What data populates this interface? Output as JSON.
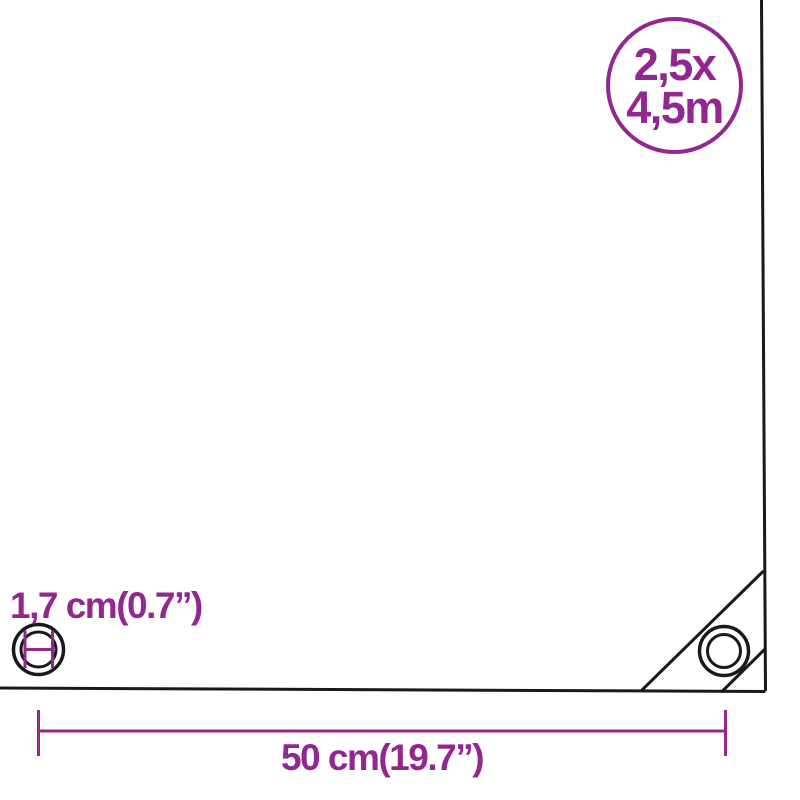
{
  "diagram": {
    "size_badge": {
      "line1": "2,5x",
      "line2": "4,5m"
    },
    "eyelet_diameter_label": "1,7 cm(0.7”)",
    "grommet_spacing_label": "50 cm(19.7”)"
  },
  "colors": {
    "accent_purple": "#92278F",
    "outline_black": "#191919",
    "background": "#FFFFFF"
  },
  "icons": {
    "eyelet_diameter_icon": "double-black-circle-with-purple-inner-diameter-measure",
    "corner_grommet_icon": "double-black-circle-grommet"
  }
}
